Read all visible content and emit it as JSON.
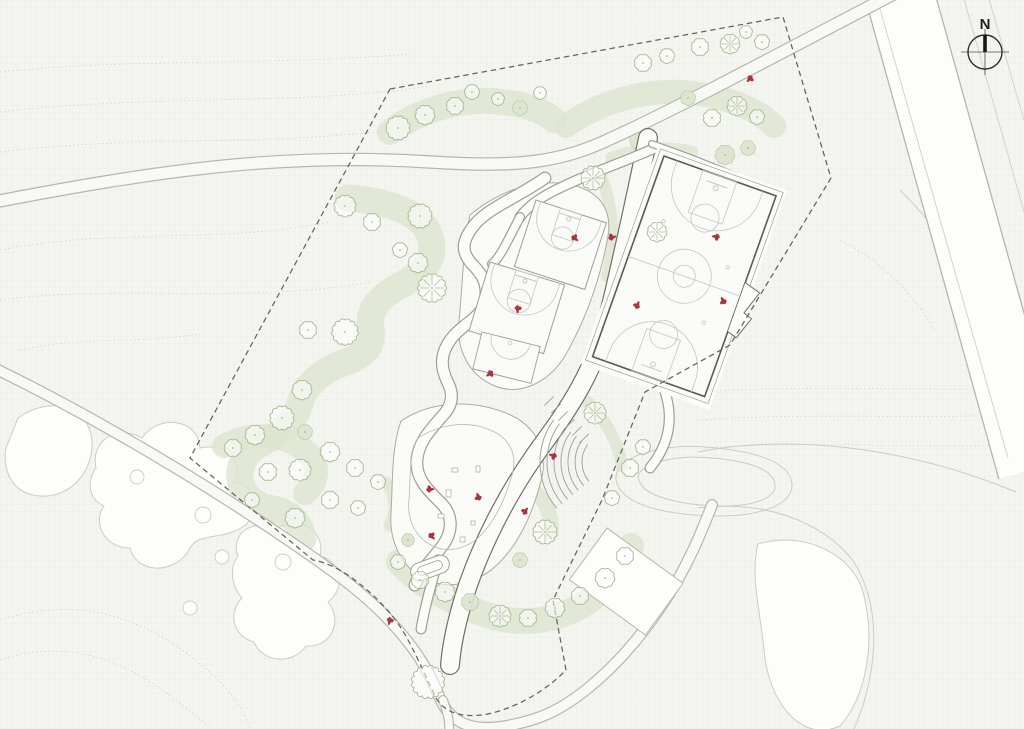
{
  "meta": {
    "drawing_type": "landscape site plan"
  },
  "compass": {
    "label": "N",
    "cx": 985,
    "cy": 52,
    "r": 17
  },
  "colors": {
    "background": "#f4f5f1",
    "contour": "#ccd1c5",
    "road_line": "#b3b8ae",
    "lane_line": "#cdd1c7",
    "path_edge": "#9aa097",
    "dark_edge": "#6a706a",
    "path_fill": "#fbfcf8",
    "plaza_fill": "#fafbf7",
    "plaza_edge": "#a8ada4",
    "green_fill": "#dce5cf",
    "green_stroke": "#bdc9a9",
    "tree_stroke": "#a7b995",
    "court_border": "#565c55",
    "court_line": "#c3c7bf",
    "boundary": "#60645d",
    "figure_red": "#a93440",
    "field_fill": "#fdfdfc",
    "field_edge": "#c9cdc2"
  },
  "contours": [
    "M0,72 C130,58 270,66 410,54",
    "M0,112 C150,94 300,106 430,86",
    "M0,152 C140,134 290,148 415,126",
    "M0,250 C110,228 220,244 330,222",
    "M0,300 C120,284 250,304 370,282",
    "M20,350 C80,336 140,344 200,334",
    "M700,392 C810,384 930,392 1014,388",
    "M698,420 C812,412 934,420 1014,414",
    "M704,448 C822,440 944,450 1014,444",
    "M0,620 C70,598 130,612 185,652 C225,682 242,704 250,729",
    "M0,660 C60,640 115,655 165,692 C195,715 205,722 210,729",
    "M840,240 C880,260 910,290 935,330"
  ],
  "fields": {
    "blobs": [
      "M18,418 C48,396 88,404 92,440 C94,470 72,498 40,496 C12,494 2,470 6,448 Z",
      "M96,468 C90,440 118,424 142,438 C158,414 198,418 200,448 C226,442 244,460 234,482 C258,486 262,512 244,526 C222,542 196,530 188,552 C170,576 136,572 130,548 C104,548 92,522 104,506 C86,498 88,478 96,468 Z",
      "M238,556 C230,534 252,518 274,530 C298,514 326,530 320,556 C342,562 346,588 328,602 C344,622 330,648 306,646 C292,666 262,662 254,642 C232,636 228,612 242,598 C230,584 230,566 238,556 Z",
      "M758,544 C798,532 846,548 862,588 C878,644 864,700 840,726 C800,744 768,700 764,650 C760,610 750,574 758,544 Z"
    ],
    "curves": [
      "M698,452 C790,434 905,446 1016,492",
      "M698,508 C762,500 822,520 854,562 C886,614 874,684 854,729",
      "M618,470 C630,452 668,444 706,447 C756,451 790,462 792,484 C793,505 760,516 720,516 C676,516 636,508 622,492 C616,484 614,478 618,470 Z",
      "M640,472 C652,460 682,455 712,458 C750,461 774,470 775,485 C776,499 750,507 718,506 C684,505 652,498 642,486 C638,480 637,477 640,472 Z",
      "M900,190 C940,230 975,280 998,330"
    ],
    "circles": [
      [
        137,
        477,
        7
      ],
      [
        203,
        515,
        8
      ],
      [
        222,
        557,
        7
      ],
      [
        283,
        562,
        8
      ],
      [
        190,
        608,
        7
      ]
    ]
  },
  "greens": {
    "spines": [
      {
        "d": "M390,132 C420,110 458,99 492,101 C518,103 540,108 554,120",
        "w": 26
      },
      {
        "d": "M566,126 C608,96 662,86 706,95 C738,101 760,112 774,126",
        "w": 24
      },
      {
        "d": "M612,158 C642,148 670,147 692,152",
        "w": 13
      },
      {
        "d": "M348,198 C396,202 426,216 431,240 C436,262 419,276 399,286 C379,297 367,311 371,329 C375,345 363,357 343,363 C321,371 305,386 300,403 C295,421 282,433 265,441 C248,449 238,463 240,479 C242,496 256,506 273,509 C291,513 301,523 303,539",
        "w": 27
      },
      {
        "d": "M399,562 C421,586 449,601 481,613 C516,626 551,623 581,606 C606,591 623,569 631,546",
        "w": 26
      },
      {
        "d": "M601,176 C613,206 616,243 607,276",
        "w": 12
      },
      {
        "d": "M636,220 C640,248 641,275 637,300",
        "w": 10
      },
      {
        "d": "M648,302 C660,332 662,352 655,374",
        "w": 11
      },
      {
        "d": "M224,446 C252,431 286,433 308,453 C320,466 318,483 305,493",
        "w": 24
      },
      {
        "d": "M522,482 C542,494 553,512 551,532",
        "w": 15
      },
      {
        "d": "M588,402 C606,420 618,442 622,466",
        "w": 12
      },
      {
        "d": "M386,482 C396,497 396,513 389,526",
        "w": 11
      }
    ],
    "blobs": [
      "M632,130 C640,125 650,127 653,136 C655,145 648,153 639,151 C630,149 627,136 632,130 Z"
    ]
  },
  "roads": {
    "main": {
      "d": "M899,-8 L1032,470",
      "w": 70
    },
    "lanes": [
      "M962,-8 L1032,240",
      "M987,-8 L1032,148",
      "M876,-5 L1008,458"
    ],
    "minor": [
      {
        "d": "M-6,202 C150,172 280,152 430,162 C520,168 562,162 612,138 C682,106 790,48 905,-12",
        "w": 13.5
      },
      {
        "d": "M-6,368 C60,400 170,460 285,538 C340,575 372,600 398,630 C420,655 431,676 439,696 C449,722 470,731 500,727 C540,721 562,709 587,689 C622,661 652,623 674,586 C692,556 702,530 712,505",
        "w": 12
      },
      {
        "d": "M443,700 C448,714 450,722 449,734",
        "w": 10
      }
    ]
  },
  "boundary": {
    "d": "M390,89 L783,17 L831,178 L730,345 L645,392 L602,500 L553,600 L566,670 C545,692 515,708 488,714 C462,719 444,712 436,698 C428,682 420,662 408,640 C395,615 375,595 352,578 C338,568 325,562 313,560 L190,458 Z",
    "dash": "5.5 3.8"
  },
  "paths": {
    "plazas": [
      "M470,215 C500,190 540,176 576,186 C601,193 612,211 608,236 C600,281 585,321 565,356 C548,383 520,396 495,386 C470,376 456,351 459,321 C463,281 463,246 470,215 Z",
      "M401,421 C431,401 471,399 506,413 C536,425 549,451 541,481 C533,511 521,541 499,563 C479,583 449,591 425,579 C401,567 389,541 391,513 C393,481 391,449 401,421 Z"
    ],
    "walks": [
      {
        "d": "M648,138 C635,200 622,260 608,318 C592,380 560,420 535,455 C505,498 482,545 468,585 C458,615 452,640 450,665",
        "w": 20,
        "dark": true
      },
      {
        "d": "M545,178 C520,196 492,206 476,223 C459,243 463,253 471,263 C481,273 489,283 485,301 C481,319 463,323 451,339 C439,355 441,369 448,383 C453,393 453,403 445,413 C431,429 419,441 417,459 C415,479 429,491 441,503 C453,515 453,531 443,545 C433,559 421,569 415,585",
        "w": 13,
        "dark": false
      },
      {
        "d": "M655,148 C622,163 590,173 562,187 C542,196 528,206 520,217",
        "w": 11,
        "dark": false
      },
      {
        "d": "M608,318 C640,345 660,370 667,399 C673,424 667,447 650,468",
        "w": 11,
        "dark": false
      },
      {
        "d": "M438,560 C431,585 425,606 421,629",
        "w": 11,
        "dark": false
      },
      {
        "d": "M652,144 C692,158 731,173 772,193",
        "w": 8,
        "dark": false
      },
      {
        "d": "M520,217 C508,240 500,258 492,264",
        "w": 10,
        "dark": false
      }
    ],
    "loop_inner": "M418,438 C440,424 468,420 490,430 C510,438 518,455 512,475 C506,496 497,518 482,534 C468,549 447,554 431,545 C414,536 407,518 409,500 C411,478 408,456 418,438 Z",
    "pads": [
      {
        "x": 607,
        "y": 528,
        "a": 36,
        "w": 94,
        "h": 64
      }
    ]
  },
  "courts": {
    "main": {
      "x": 664,
      "y": 156,
      "a": 19.6,
      "w": 119,
      "h": 213
    },
    "half": [
      {
        "x": 536,
        "y": 200,
        "a": 18,
        "w": 74,
        "h": 70
      },
      {
        "x": 490,
        "y": 262,
        "a": 17,
        "w": 78,
        "h": 72
      }
    ],
    "mini": {
      "x": 482,
      "y": 332,
      "a": 14,
      "w": 60,
      "h": 38
    }
  },
  "play": {
    "amphitheater": {
      "cx": 612,
      "cy": 462,
      "r0": 30,
      "dr": 7,
      "n": 7,
      "a1": 140,
      "a2": 216
    },
    "stairs": {
      "x": 549,
      "y": 401,
      "dx": 7,
      "dy": 7.5,
      "n": 6,
      "half": 6.5
    },
    "equipment": [
      [
        452,
        468,
        6,
        4
      ],
      [
        446,
        490,
        5,
        7
      ],
      [
        438,
        514,
        6,
        4
      ],
      [
        460,
        537,
        5,
        5
      ],
      [
        476,
        466,
        4,
        6
      ],
      [
        471,
        521,
        4,
        4
      ]
    ],
    "bean": {
      "x": 430,
      "y": 568,
      "a": -20
    }
  },
  "trees": [
    [
      398,
      128,
      11,
      "o"
    ],
    [
      425,
      115,
      9,
      "o"
    ],
    [
      455,
      106,
      8,
      "o"
    ],
    [
      472,
      92,
      7,
      "o"
    ],
    [
      498,
      99,
      6,
      "o"
    ],
    [
      520,
      108,
      7,
      "g"
    ],
    [
      540,
      93,
      6,
      "o"
    ],
    [
      643,
      63,
      8,
      "o"
    ],
    [
      667,
      56,
      7,
      "o"
    ],
    [
      700,
      47,
      8,
      "o"
    ],
    [
      730,
      44,
      9,
      "s"
    ],
    [
      746,
      32,
      6,
      "o"
    ],
    [
      762,
      42,
      7,
      "o"
    ],
    [
      688,
      98,
      7,
      "g"
    ],
    [
      712,
      118,
      8,
      "o"
    ],
    [
      737,
      106,
      9,
      "s"
    ],
    [
      757,
      117,
      7,
      "o"
    ],
    [
      725,
      155,
      9,
      "g"
    ],
    [
      748,
      148,
      7,
      "g"
    ],
    [
      593,
      178,
      11,
      "s"
    ],
    [
      657,
      232,
      9,
      "s"
    ],
    [
      345,
      206,
      10,
      "o"
    ],
    [
      372,
      222,
      8,
      "o"
    ],
    [
      420,
      216,
      11,
      "o"
    ],
    [
      400,
      250,
      7,
      "o"
    ],
    [
      418,
      263,
      9,
      "o"
    ],
    [
      432,
      288,
      13,
      "s"
    ],
    [
      345,
      332,
      12,
      "o"
    ],
    [
      308,
      330,
      8,
      "o"
    ],
    [
      302,
      390,
      9,
      "o"
    ],
    [
      282,
      418,
      11,
      "o"
    ],
    [
      255,
      435,
      9,
      "o"
    ],
    [
      233,
      448,
      8,
      "o"
    ],
    [
      305,
      432,
      7,
      "g"
    ],
    [
      330,
      452,
      9,
      "o"
    ],
    [
      355,
      468,
      8,
      "o"
    ],
    [
      378,
      482,
      7,
      "o"
    ],
    [
      300,
      470,
      10,
      "o"
    ],
    [
      268,
      472,
      8,
      "o"
    ],
    [
      252,
      500,
      7,
      "o"
    ],
    [
      330,
      500,
      8,
      "o"
    ],
    [
      358,
      508,
      7,
      "o"
    ],
    [
      295,
      518,
      9,
      "o"
    ],
    [
      398,
      562,
      7,
      "o"
    ],
    [
      420,
      580,
      8,
      "o"
    ],
    [
      445,
      592,
      9,
      "o"
    ],
    [
      470,
      602,
      8,
      "g"
    ],
    [
      500,
      616,
      10,
      "s"
    ],
    [
      528,
      618,
      8,
      "o"
    ],
    [
      555,
      608,
      9,
      "o"
    ],
    [
      580,
      596,
      8,
      "o"
    ],
    [
      605,
      578,
      9,
      "o"
    ],
    [
      625,
      556,
      8,
      "o"
    ],
    [
      428,
      682,
      15,
      "o"
    ],
    [
      520,
      560,
      7,
      "g"
    ],
    [
      545,
      532,
      11,
      "s"
    ],
    [
      595,
      413,
      10,
      "s"
    ],
    [
      630,
      468,
      8,
      "o"
    ],
    [
      643,
      447,
      7,
      "o"
    ],
    [
      612,
      498,
      7,
      "o"
    ],
    [
      408,
      540,
      6,
      "g"
    ]
  ],
  "figures": [
    [
      750,
      79
    ],
    [
      716,
      237
    ],
    [
      723,
      301
    ],
    [
      637,
      305
    ],
    [
      612,
      237
    ],
    [
      575,
      238
    ],
    [
      518,
      309
    ],
    [
      490,
      374
    ],
    [
      553,
      456
    ],
    [
      478,
      497
    ],
    [
      525,
      511
    ],
    [
      430,
      489
    ],
    [
      432,
      536
    ],
    [
      390,
      621
    ]
  ]
}
